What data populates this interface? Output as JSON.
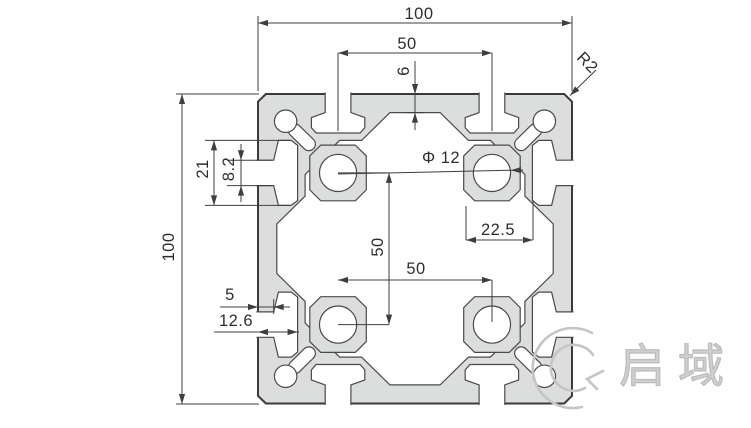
{
  "dimensions": {
    "top_width": "100",
    "top_slot_spacing": "50",
    "top_wall_thickness": "6",
    "corner_radius": "R2",
    "side_slot_inner_width": "21",
    "side_slot_opening": "8.2",
    "left_height": "100",
    "hole_diameter": "Φ 12",
    "web_width": "22.5",
    "hole_spacing_vertical": "50",
    "hole_spacing_horizontal": "50",
    "slot_lip_depth": "5",
    "slot_depth": "12.6"
  },
  "watermark": {
    "text": "启域"
  },
  "colors": {
    "background": "#ffffff",
    "profile_fill": "#dcdedd",
    "outer_line": "#3a3a3a",
    "inner_line": "#4a4a4a",
    "dim_line": "#3f3f3f",
    "watermark": "#c5c5c5"
  }
}
